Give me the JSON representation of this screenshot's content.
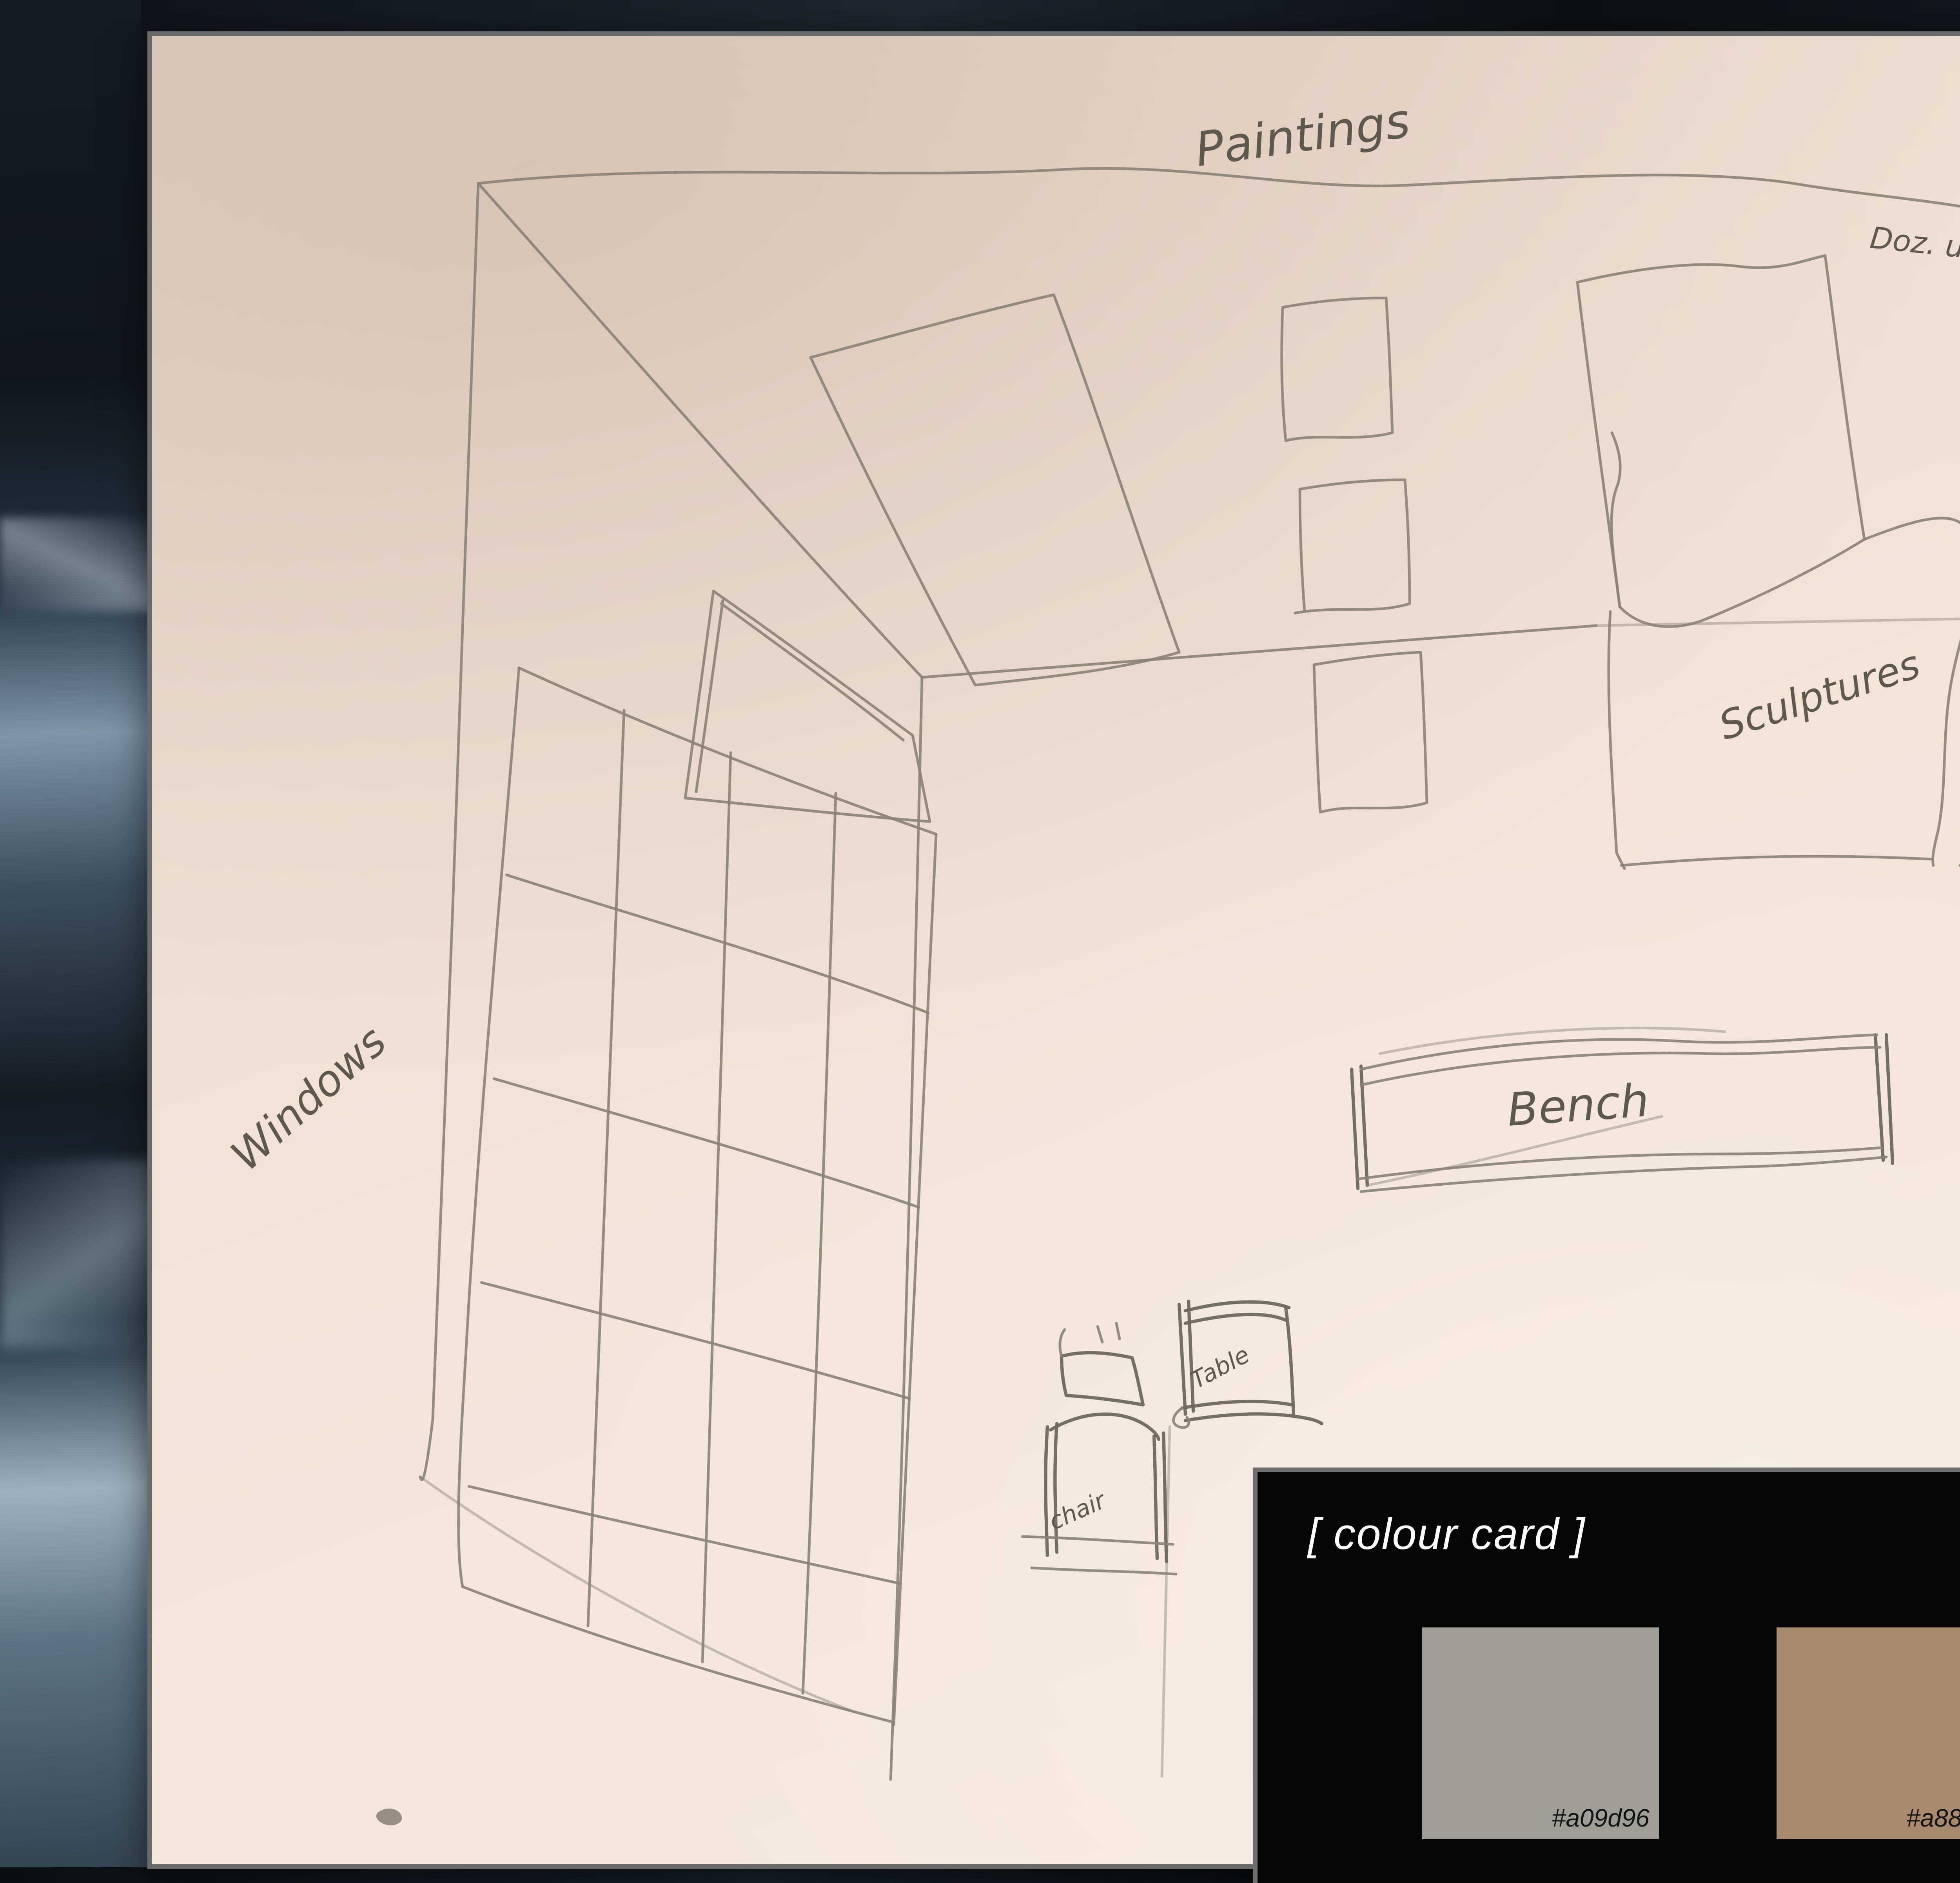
{
  "photo": {
    "description": "pencil sketch of a gallery room layout on peach paper, photographed on dark marble",
    "labels": {
      "paintings": "Paintings",
      "wall_note": "Doz. u Kan",
      "sculptures": "Sculptures",
      "windows": "Windows",
      "bench": "Bench",
      "table": "Table",
      "chair": "chair"
    }
  },
  "colour_card": {
    "title": "[ colour card ]",
    "swatches": [
      {
        "name": "warm-grey",
        "hex": "#a09d96",
        "label": "#a09d96"
      },
      {
        "name": "tan-brown",
        "hex": "#a8896d",
        "label": "#a8896d"
      },
      {
        "name": "white",
        "hex": "#ffffff",
        "label": "#ffffff"
      }
    ]
  },
  "colors": {
    "paper": "#f1e2d7",
    "pencil": "#8b8275",
    "card_background": "#050505",
    "card_border": "#6f6f6f",
    "marble_dark": "#11171d",
    "marble_light": "#9fb2c0"
  }
}
